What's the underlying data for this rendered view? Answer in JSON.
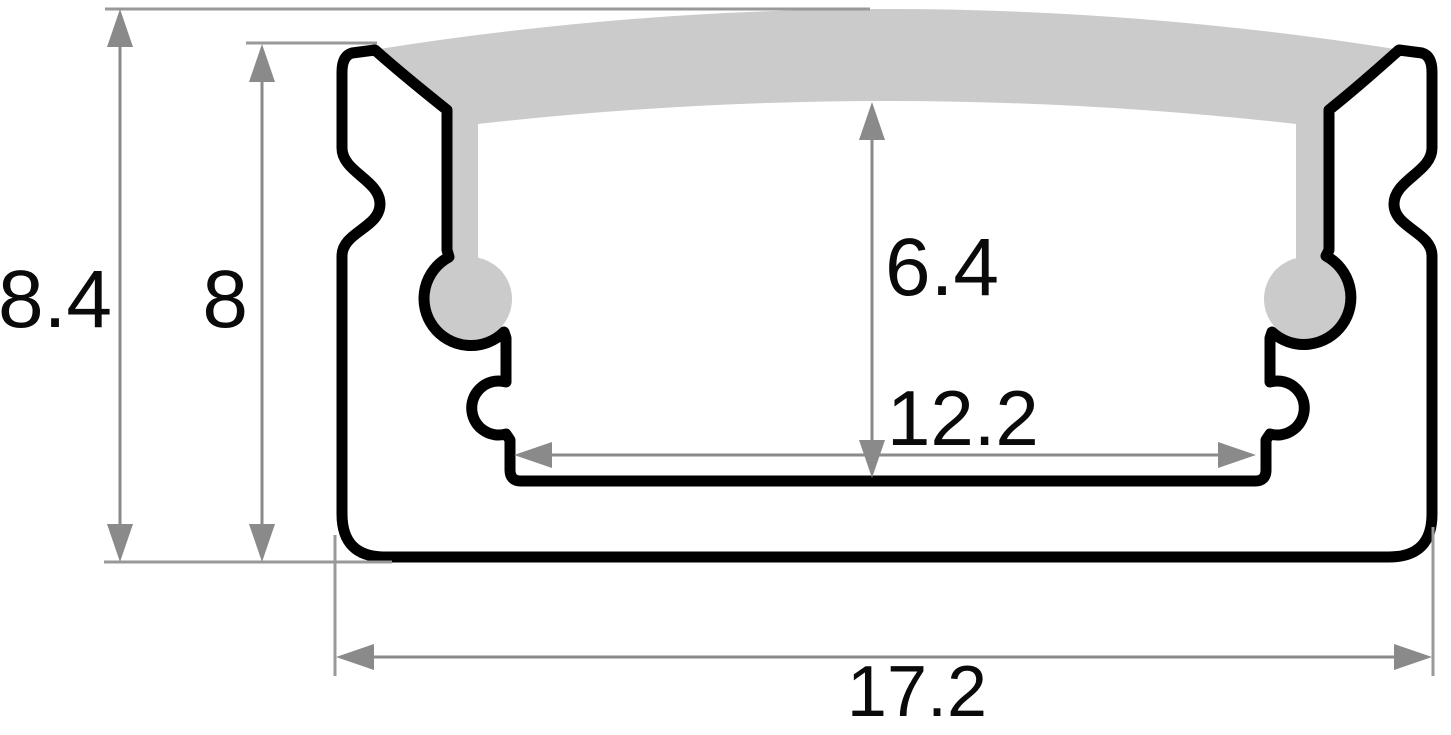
{
  "diagram": {
    "type": "technical-cross-section",
    "subject": "LED aluminium profile cross-section with diffuser and dimensions",
    "dimensions": {
      "overall_height": "8.4",
      "body_height": "8",
      "inner_height": "6.4",
      "inner_width": "12.2",
      "overall_width": "17.2"
    },
    "colors": {
      "outline": "#000000",
      "diffuser_fill": "#cbcbcb",
      "dimension": "#8a8a8a",
      "extension": "#999999",
      "background": "#ffffff"
    }
  }
}
